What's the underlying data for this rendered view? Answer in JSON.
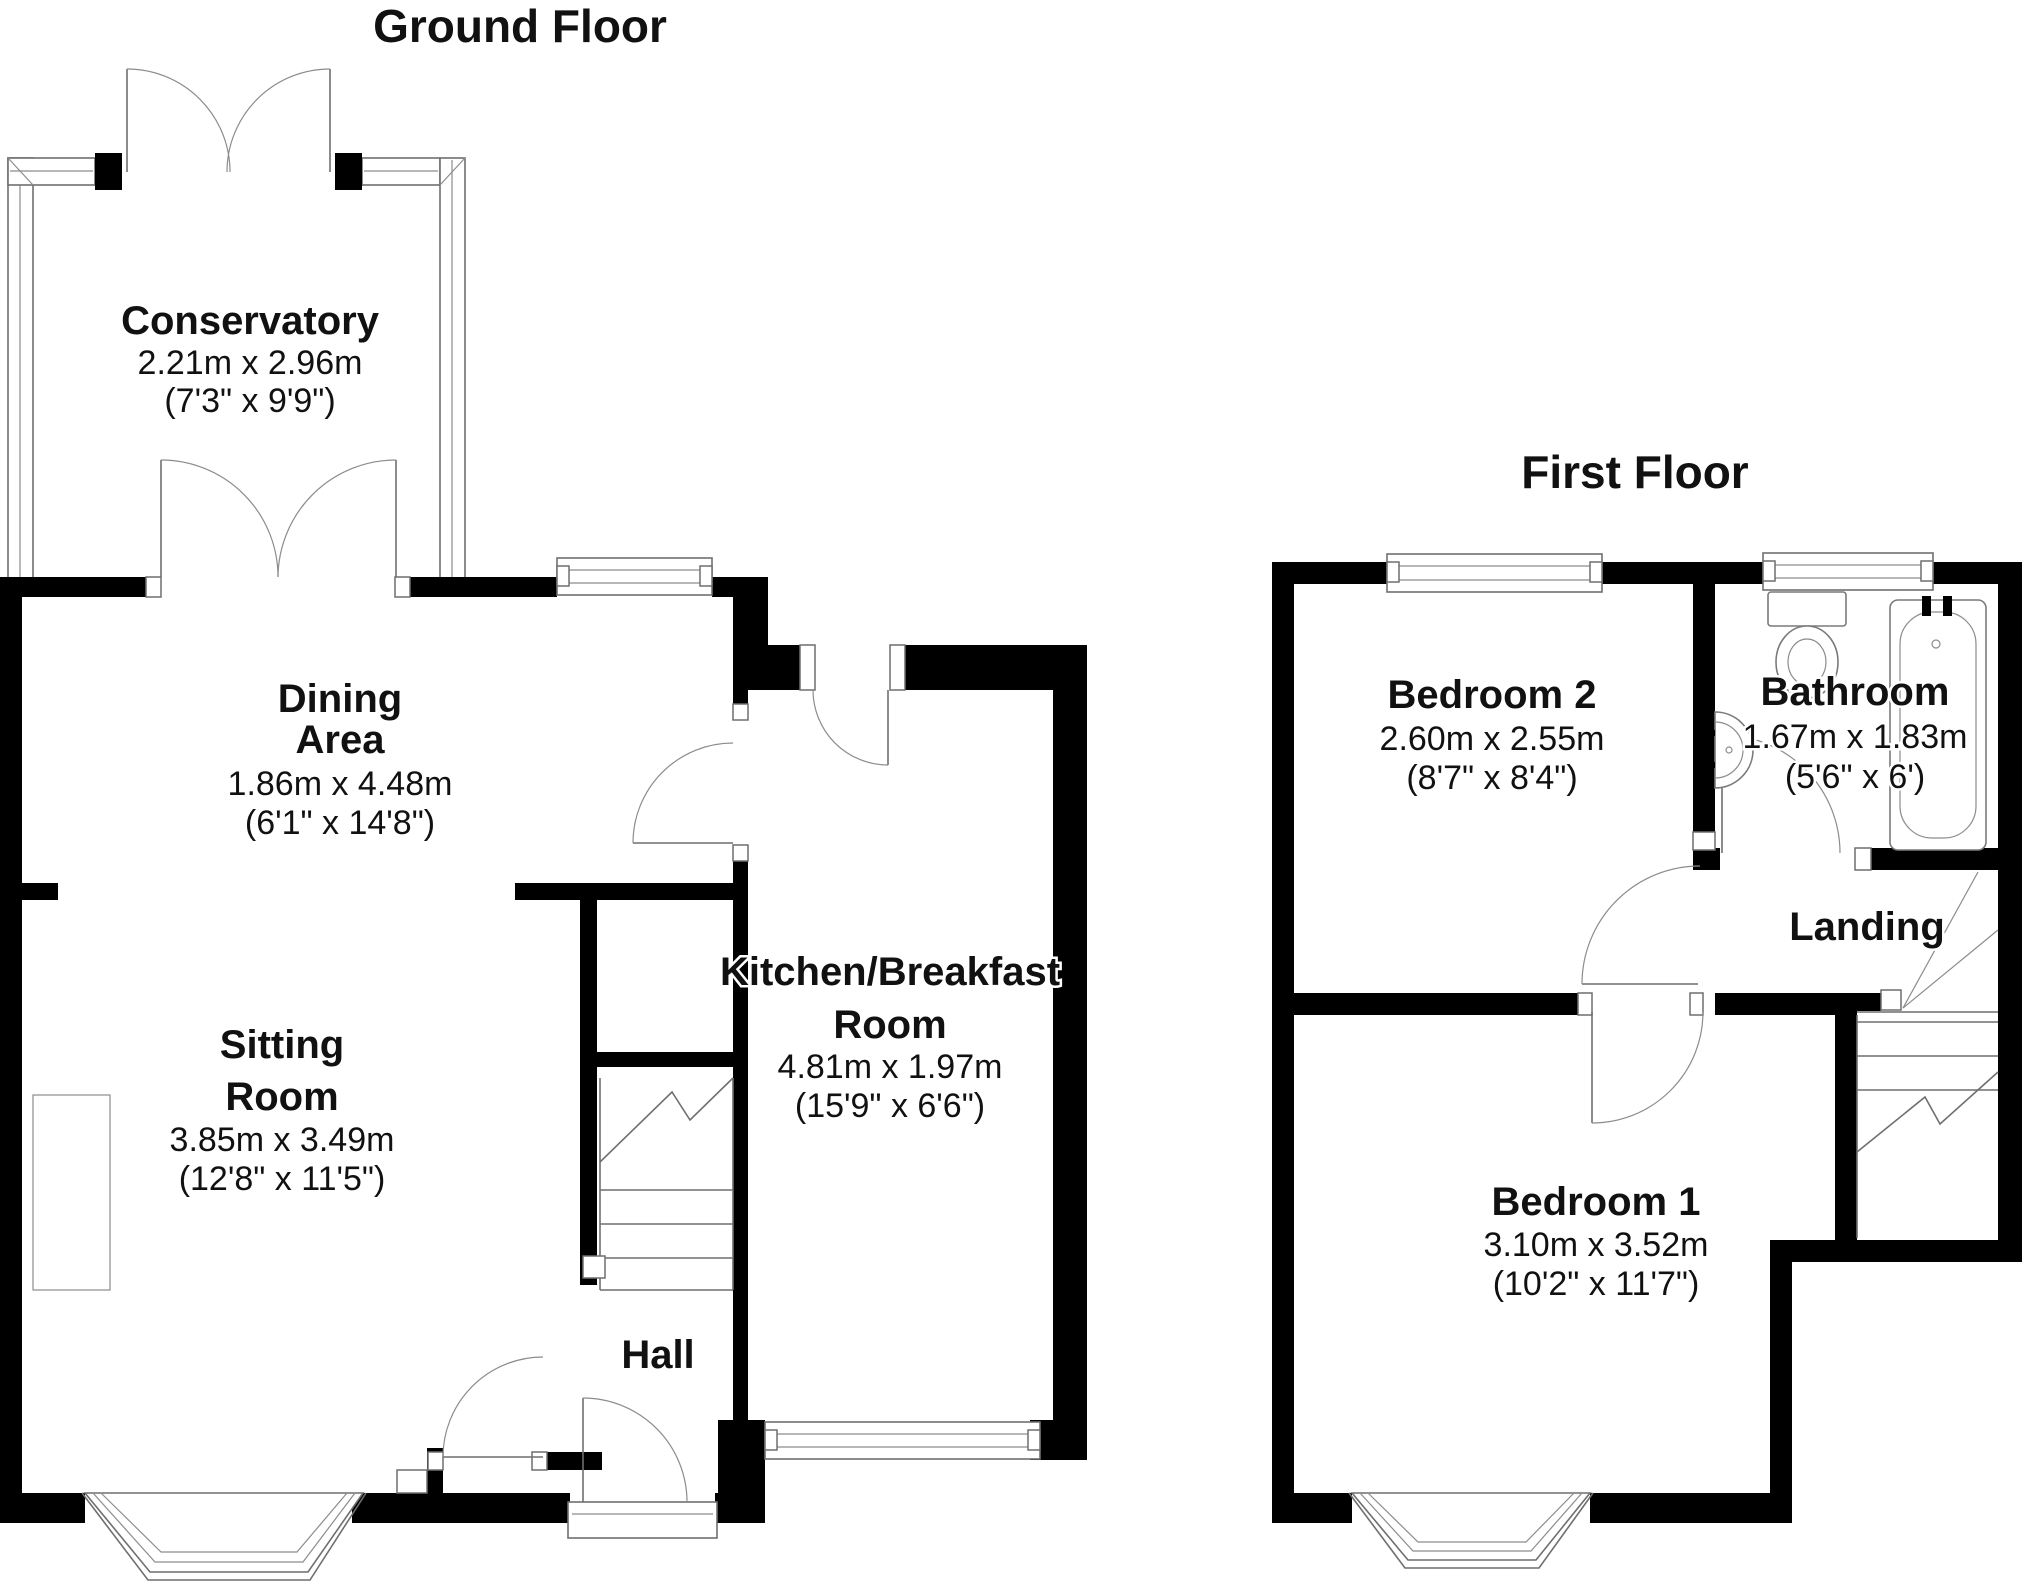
{
  "page_title": "Floorplan",
  "colors": {
    "wall": "#000000",
    "detail_line": "#6f6f6f",
    "background": "#ffffff",
    "text": "#111111"
  },
  "ground_floor": {
    "title": "Ground Floor",
    "rooms": {
      "conservatory": {
        "name": "Conservatory",
        "metric": "2.21m x 2.96m",
        "imperial": "(7'3\" x 9'9\")"
      },
      "dining_area": {
        "line1": "Dining",
        "line2": "Area",
        "metric": "1.86m x 4.48m",
        "imperial": "(6'1\" x 14'8\")"
      },
      "sitting_room": {
        "line1": "Sitting",
        "line2": "Room",
        "metric": "3.85m x 3.49m",
        "imperial": "(12'8\" x 11'5\")"
      },
      "kitchen": {
        "line1": "Kitchen/Breakfast",
        "line2": "Room",
        "metric": "4.81m x 1.97m",
        "imperial": "(15'9\" x 6'6\")"
      },
      "hall": {
        "name": "Hall"
      }
    }
  },
  "first_floor": {
    "title": "First Floor",
    "rooms": {
      "bedroom2": {
        "name": "Bedroom 2",
        "metric": "2.60m x 2.55m",
        "imperial": "(8'7\" x 8'4\")"
      },
      "bathroom": {
        "name": "Bathroom",
        "metric": "1.67m x 1.83m",
        "imperial": "(5'6\" x 6')"
      },
      "landing": {
        "name": "Landing"
      },
      "bedroom1": {
        "name": "Bedroom 1",
        "metric": "3.10m x 3.52m",
        "imperial": "(10'2\" x 11'7\")"
      }
    }
  }
}
